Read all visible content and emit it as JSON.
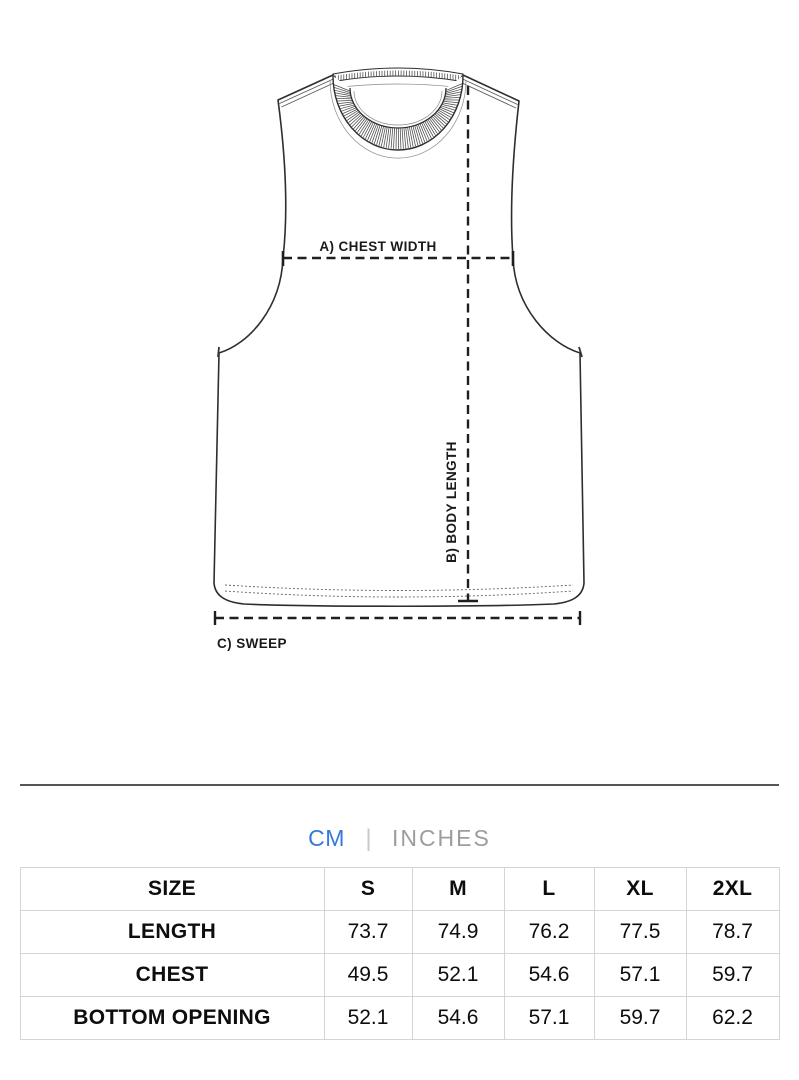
{
  "diagram": {
    "labels": {
      "a": "A) CHEST WIDTH",
      "b": "B) BODY LENGTH",
      "c": "C) SWEEP"
    }
  },
  "units": {
    "cm": "CM",
    "separator": "|",
    "inches": "INCHES",
    "active": "CM",
    "active_color": "#3579DB",
    "inactive_color": "#9D9D9D"
  },
  "size_table": {
    "columns": [
      "SIZE",
      "S",
      "M",
      "L",
      "XL",
      "2XL"
    ],
    "rows": [
      {
        "label": "LENGTH",
        "values": [
          "73.7",
          "74.9",
          "76.2",
          "77.5",
          "78.7"
        ]
      },
      {
        "label": "CHEST",
        "values": [
          "49.5",
          "52.1",
          "54.6",
          "57.1",
          "59.7"
        ]
      },
      {
        "label": "BOTTOM OPENING",
        "values": [
          "52.1",
          "54.6",
          "57.1",
          "59.7",
          "62.2"
        ]
      }
    ]
  }
}
